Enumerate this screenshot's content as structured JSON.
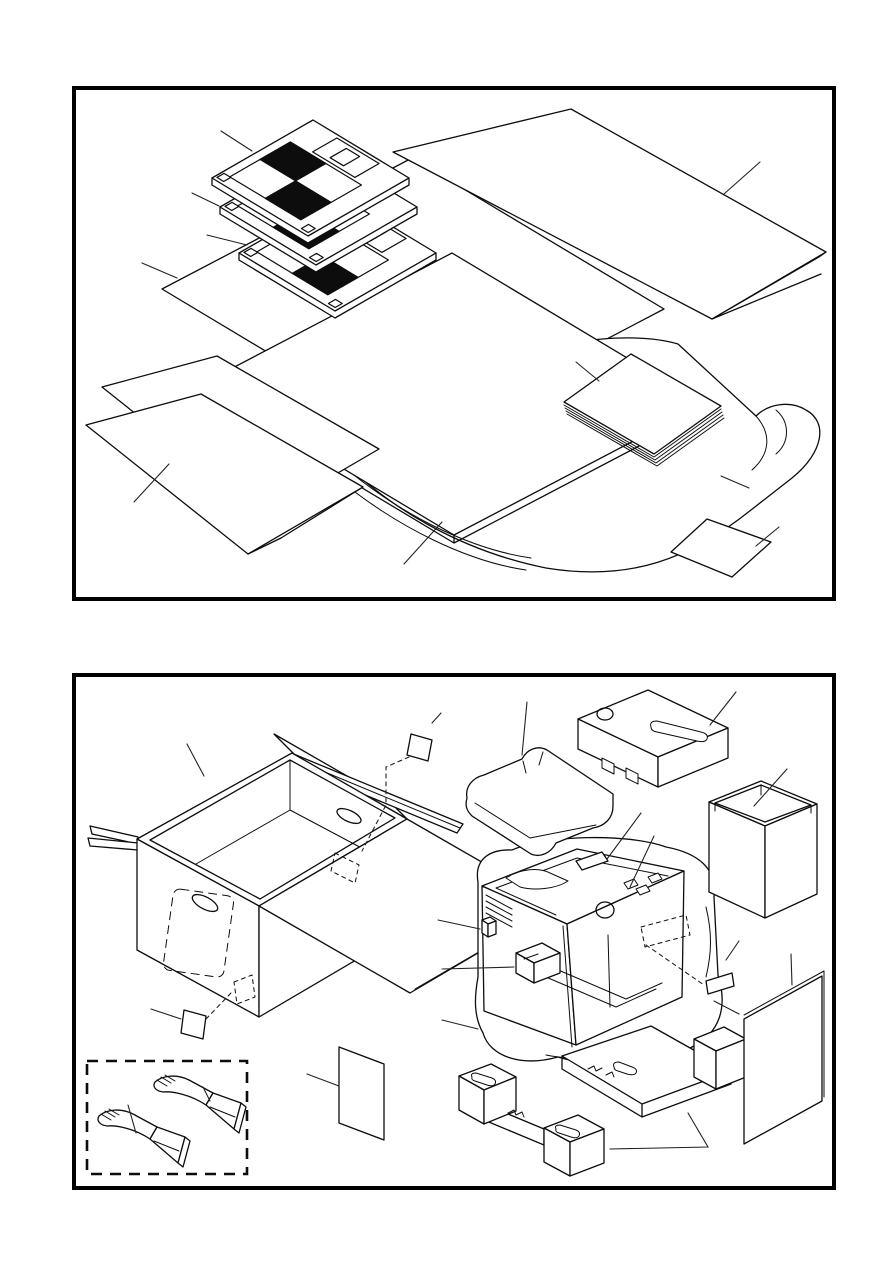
{
  "canvas": {
    "width_px": 893,
    "height_px": 1263,
    "background": "#ffffff",
    "line_color": "#0d0d0d",
    "visible_text": "none"
  },
  "figures": [
    {
      "name": "accessory-items-exploded-packing",
      "frame": {
        "left_px": 72,
        "top_px": 86,
        "width_px": 764,
        "height_px": 515,
        "border_color": "#000000",
        "border_px": 4
      },
      "parts": [
        {
          "name": "floppy-disk-1",
          "description": "3.5-inch diskette, checkered label, top of stack"
        },
        {
          "name": "floppy-disk-2",
          "description": "3.5-inch diskette, middle of stack"
        },
        {
          "name": "floppy-disk-3",
          "description": "3.5-inch diskette, bottom of stack"
        },
        {
          "name": "flat-sheet-under-disks",
          "description": "flat protective sheet beneath diskettes"
        },
        {
          "name": "folded-sheet-top-right",
          "description": "large folded sheet, upper right"
        },
        {
          "name": "cardboard-pad",
          "description": "thick flat cardboard pad, center"
        },
        {
          "name": "paper-stack",
          "description": "stack of paper sheets on pad"
        },
        {
          "name": "plastic-bag",
          "description": "plastic bag with rounded open end, lower right"
        },
        {
          "name": "folded-sheet-bottom-left-rear",
          "description": "flat sheet, lower left, rear"
        },
        {
          "name": "folded-sheet-bottom-left-front",
          "description": "folded sheet, lower left, front"
        },
        {
          "name": "small-card",
          "description": "small card, bottom right"
        },
        {
          "name": "leader-lines",
          "count": 10
        }
      ]
    },
    {
      "name": "machine-carton-exploded-packing",
      "frame": {
        "left_px": 72,
        "top_px": 673,
        "width_px": 764,
        "height_px": 517,
        "border_color": "#000000",
        "border_px": 4
      },
      "parts": [
        {
          "name": "shipping-carton",
          "description": "open corrugated carton with flaps and hand holes"
        },
        {
          "name": "packing-card-top",
          "description": "small card above carton with hidden-position dashes"
        },
        {
          "name": "packing-card-front",
          "description": "small card at carton front with hidden-position dashes"
        },
        {
          "name": "paper-support-brackets-box",
          "description": "dashed enclosure, lower left",
          "style": "dashed"
        },
        {
          "name": "paper-support-bracket-1",
          "description": "curved support bracket, lower"
        },
        {
          "name": "paper-support-bracket-2",
          "description": "curved support bracket, upper"
        },
        {
          "name": "flat-sheet-center",
          "description": "small flat sheet, bottom center"
        },
        {
          "name": "foam-corner-pad",
          "description": "foam corner pad, upper middle"
        },
        {
          "name": "foam-top-insert",
          "description": "foam top insert with slot and hole cutouts"
        },
        {
          "name": "accessory-carton",
          "description": "open-top accessory box, upper right"
        },
        {
          "name": "machine-in-plastic-bag",
          "description": "machine wrapped in plastic bag, center right"
        },
        {
          "name": "side-block",
          "description": "small block on machine left side"
        },
        {
          "name": "cartridge-block",
          "description": "cartridge block inside machine front"
        },
        {
          "name": "tag-card",
          "description": "small tag card right of machine with dashed pointer"
        },
        {
          "name": "protective-sheet-right",
          "description": "flat protective sheet, right"
        },
        {
          "name": "foam-bottom-tray",
          "description": "foam bottom tray under machine"
        },
        {
          "name": "foam-bottom-end-cap",
          "description": "foam bottom end cap, front"
        },
        {
          "name": "leader-lines",
          "count": 14
        }
      ]
    }
  ]
}
